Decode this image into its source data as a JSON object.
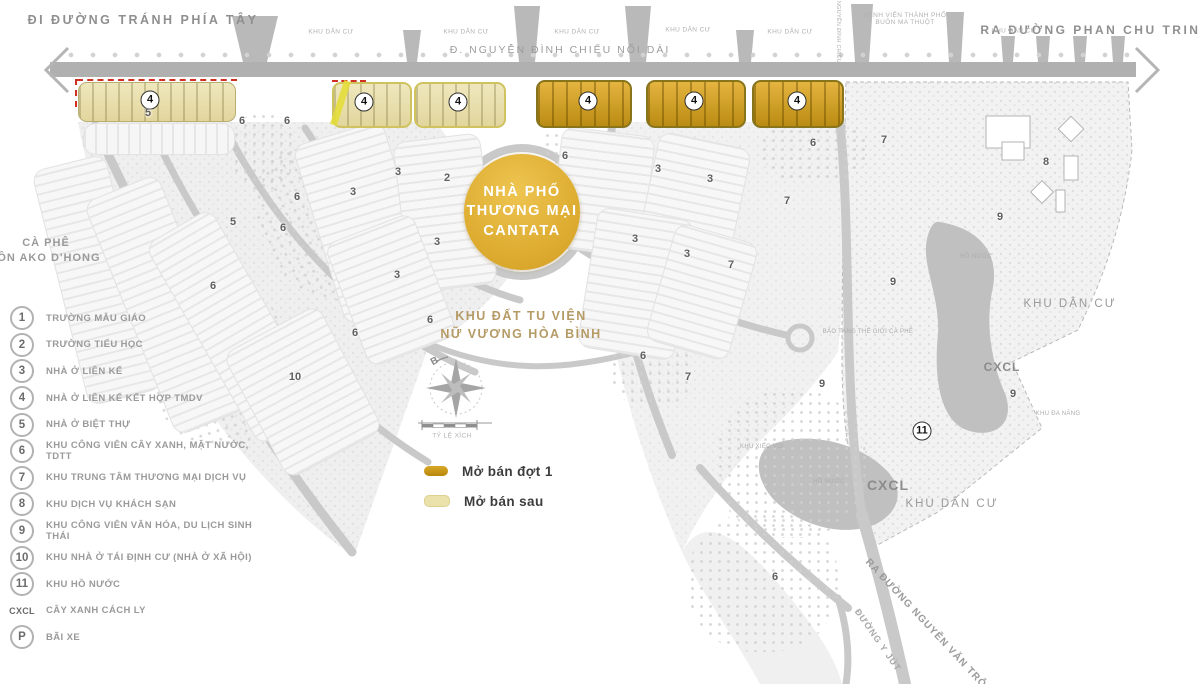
{
  "header": {
    "top_left_road": "ĐI ĐƯỜNG TRÁNH PHÍA TÂY",
    "top_right_road": "RA ĐƯỜNG PHAN CHU TRINH",
    "main_road": "Đ. NGUYỄN ĐÌNH CHIỂU NỐI DÀI",
    "vertical_road": "Đ. NGUYỄN ĐÌNH CHIỂU",
    "residential_area": "KHU DÂN CƯ",
    "hospital_line1": "BỆNH VIỆN THÀNH PHỐ",
    "hospital_line2": "BUÔN MA THUỘT"
  },
  "project": {
    "line1": "NHÀ PHỐ",
    "line2": "THƯƠNG MẠI",
    "line3": "CANTATA"
  },
  "convent": {
    "line1": "KHU ĐẤT TU VIỆN",
    "line2": "NỮ VƯƠNG HÒA BÌNH"
  },
  "cafe": {
    "line1": "CÀ PHÊ",
    "line2": "BUÔN AKO D'HONG"
  },
  "compass": {
    "north": "B",
    "scale_label": "TỶ LỆ XÍCH"
  },
  "sale_legend": {
    "phase1": "Mở bán đợt 1",
    "phase2": "Mở bán sau",
    "phase1_color": "#c9961e",
    "phase2_color": "#ebe2ab"
  },
  "area_labels": {
    "khu_dan_cu_right": "KHU DÂN CƯ",
    "khu_dan_cu_bottom": "KHU DÂN CƯ",
    "cxcl": "CXCL",
    "ho_nuoc": "HỒ NƯỚC",
    "khu_xiec_voi": "KHU XIẾC VOI",
    "bao_tang": "BẢO TÀNG THẾ GIỚI CÀ PHÊ",
    "khu_da_nang": "KHU ĐA NĂNG",
    "duong_y_jut": "ĐƯỜNG Y JÚT",
    "ra_duong_nvt": "RA ĐƯỜNG NGUYỄN VĂN TRỖI"
  },
  "legend": {
    "items": [
      {
        "key": "1",
        "label": "TRƯỜNG MẪU GIÁO"
      },
      {
        "key": "2",
        "label": "TRƯỜNG TIỂU HỌC"
      },
      {
        "key": "3",
        "label": "NHÀ Ở LIÊN KẾ"
      },
      {
        "key": "4",
        "label": "NHÀ Ở LIÊN KẾ KẾT HỢP TMDV"
      },
      {
        "key": "5",
        "label": "NHÀ Ở BIỆT THỰ"
      },
      {
        "key": "6",
        "label": "KHU CÔNG VIÊN CÂY XANH, MẶT NƯỚC, TDTT"
      },
      {
        "key": "7",
        "label": "KHU TRUNG TÂM THƯƠNG MẠI DỊCH VỤ"
      },
      {
        "key": "8",
        "label": "KHU DỊCH VỤ KHÁCH SẠN"
      },
      {
        "key": "9",
        "label": "KHU CÔNG VIÊN VĂN HÓA, DU LỊCH SINH THÁI"
      },
      {
        "key": "10",
        "label": "KHU NHÀ Ở TÁI ĐỊNH CƯ (NHÀ Ở XÃ HỘI)"
      },
      {
        "key": "11",
        "label": "KHU HỒ NƯỚC"
      },
      {
        "key": "CXCL",
        "label": "CÂY XANH CÁCH LY"
      },
      {
        "key": "P",
        "label": "BÃI XE"
      }
    ]
  },
  "map_numbers": [
    {
      "n": "4",
      "x": 150,
      "y": 100,
      "b": true
    },
    {
      "n": "4",
      "x": 364,
      "y": 102,
      "b": true
    },
    {
      "n": "4",
      "x": 458,
      "y": 102,
      "b": true
    },
    {
      "n": "4",
      "x": 588,
      "y": 101,
      "b": true
    },
    {
      "n": "4",
      "x": 694,
      "y": 101,
      "b": true
    },
    {
      "n": "4",
      "x": 797,
      "y": 101,
      "b": true
    },
    {
      "n": "11",
      "x": 922,
      "y": 431,
      "b": true
    },
    {
      "n": "5",
      "x": 148,
      "y": 113
    },
    {
      "n": "6",
      "x": 242,
      "y": 121
    },
    {
      "n": "6",
      "x": 287,
      "y": 121
    },
    {
      "n": "6",
      "x": 565,
      "y": 156
    },
    {
      "n": "6",
      "x": 813,
      "y": 143
    },
    {
      "n": "7",
      "x": 884,
      "y": 140
    },
    {
      "n": "8",
      "x": 1046,
      "y": 162
    },
    {
      "n": "2",
      "x": 447,
      "y": 178
    },
    {
      "n": "3",
      "x": 398,
      "y": 172
    },
    {
      "n": "3",
      "x": 353,
      "y": 192
    },
    {
      "n": "3",
      "x": 658,
      "y": 169
    },
    {
      "n": "3",
      "x": 710,
      "y": 179
    },
    {
      "n": "6",
      "x": 297,
      "y": 197
    },
    {
      "n": "7",
      "x": 787,
      "y": 201
    },
    {
      "n": "9",
      "x": 1000,
      "y": 217
    },
    {
      "n": "5",
      "x": 233,
      "y": 222
    },
    {
      "n": "6",
      "x": 283,
      "y": 228
    },
    {
      "n": "3",
      "x": 437,
      "y": 242
    },
    {
      "n": "3",
      "x": 635,
      "y": 239
    },
    {
      "n": "3",
      "x": 687,
      "y": 254
    },
    {
      "n": "7",
      "x": 731,
      "y": 265
    },
    {
      "n": "9",
      "x": 893,
      "y": 282
    },
    {
      "n": "3",
      "x": 397,
      "y": 275
    },
    {
      "n": "6",
      "x": 213,
      "y": 286
    },
    {
      "n": "6",
      "x": 430,
      "y": 320
    },
    {
      "n": "6",
      "x": 355,
      "y": 333
    },
    {
      "n": "6",
      "x": 643,
      "y": 356
    },
    {
      "n": "7",
      "x": 688,
      "y": 377
    },
    {
      "n": "10",
      "x": 295,
      "y": 377
    },
    {
      "n": "9",
      "x": 822,
      "y": 384
    },
    {
      "n": "9",
      "x": 1013,
      "y": 394
    },
    {
      "n": "6",
      "x": 775,
      "y": 577
    }
  ]
}
